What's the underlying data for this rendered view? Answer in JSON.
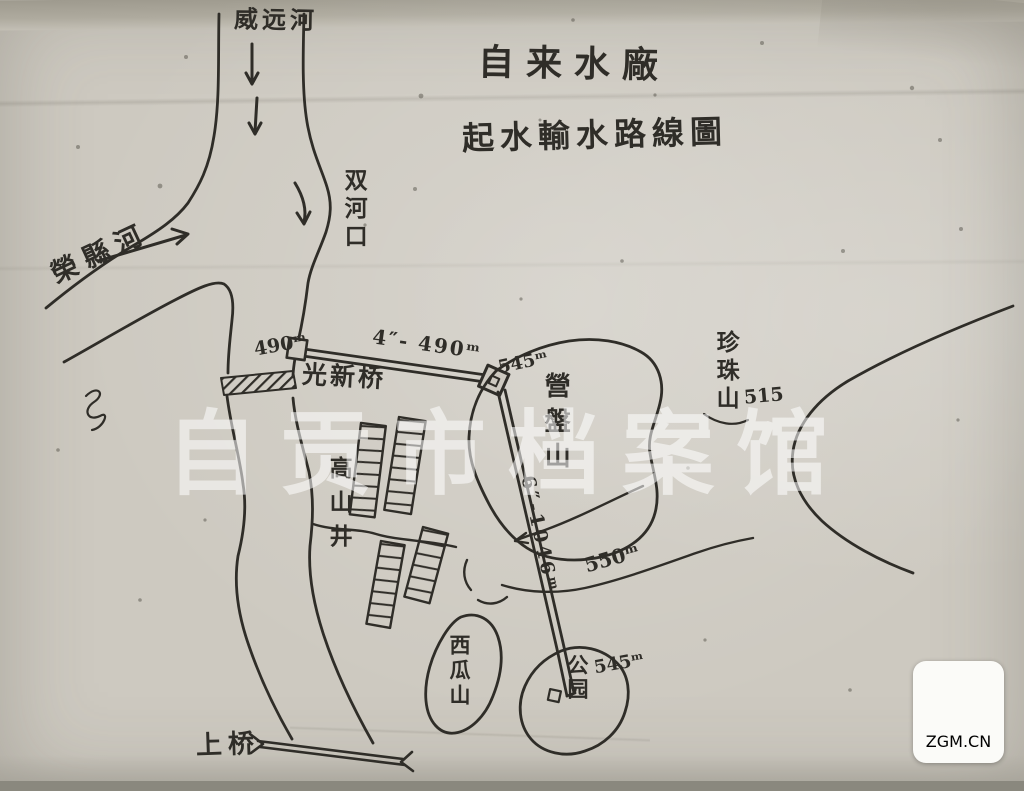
{
  "map": {
    "title": "自来水廠",
    "subtitle": "起水輸水路線圖",
    "labels": {
      "river_top": "威远河",
      "river_left": "榮縣河",
      "confluence": "双河口",
      "bridge_guangxin": "光新桥",
      "bridge_upper": "上桥",
      "mountain_yingpan": "營盤山",
      "mountain_zhenzhu": "珍珠山",
      "mountain_zhenzhu_elev": "515",
      "mountain_xigua": "西瓜山",
      "town_gaoshanjing": "高山井",
      "park": "公园",
      "park_elev": "545ᵐ",
      "pipe_start_elev": "490ᵐ",
      "pipe_seg1": "4″- 490ᵐ",
      "pipe_corner_elev": "545ᵐ",
      "pipe_seg2": "6″-1046ᵐ",
      "contour_elev": "550ᵐ"
    }
  },
  "watermark": {
    "text": "自贡市档案馆"
  },
  "badge": {
    "brand": "ZGM",
    "suffix": ".CN"
  },
  "colors": {
    "ink": "#2f2d28",
    "paper": "#cdc9c0",
    "badge_red": "#e23c34",
    "badge_orange": "#f5871c"
  }
}
